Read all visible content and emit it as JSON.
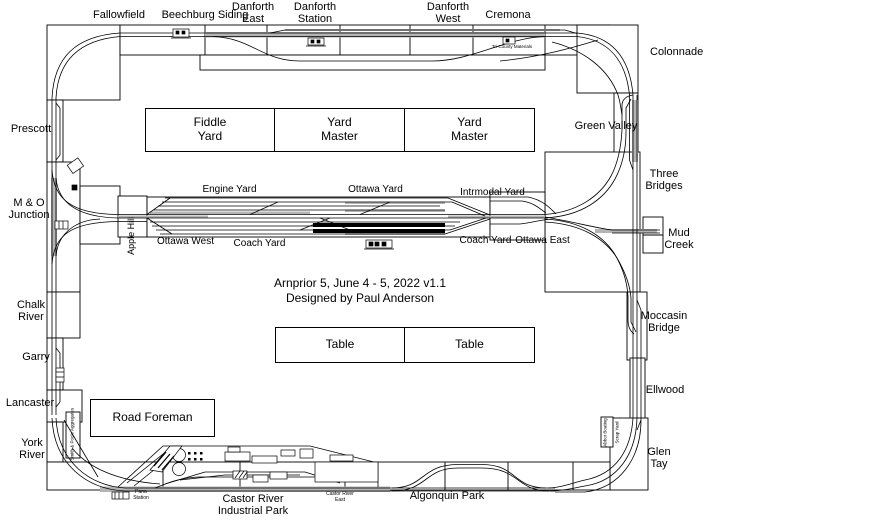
{
  "title": {
    "line1": "Arnprior 5, June 4 - 5, 2022 v1.1",
    "line2": "Designed by Paul Anderson"
  },
  "stations": {
    "top": [
      {
        "name": "Fallowfield"
      },
      {
        "name": "Beechburg Siding"
      },
      {
        "name": "Danforth East"
      },
      {
        "name": "Danforth Station"
      },
      {
        "name": "Danforth West"
      },
      {
        "name": "Cremona"
      }
    ],
    "left": [
      {
        "name": "Prescott"
      },
      {
        "name": "M & O Junction"
      },
      {
        "name": "Chalk River"
      },
      {
        "name": "Garry"
      },
      {
        "name": "Lancaster"
      },
      {
        "name": "York River"
      }
    ],
    "right": [
      {
        "name": "Colonnade"
      },
      {
        "name": "Green Valley"
      },
      {
        "name": "Three Bridges"
      },
      {
        "name": "Mud Creek"
      },
      {
        "name": "Moccasin Bridge"
      },
      {
        "name": "Ellwood"
      },
      {
        "name": "Glen Tay"
      }
    ],
    "bottom": [
      {
        "name": "Pana Station"
      },
      {
        "name": "Castor River Industrial Park"
      },
      {
        "name": "Castor River East"
      },
      {
        "name": "Algonquin Park"
      }
    ]
  },
  "yards": {
    "engine": "Engine Yard",
    "ottawa": "Ottawa Yard",
    "intermodal": "Intrmodal Yard",
    "ottawa_west": "Ottawa West",
    "coach_left": "Coach Yard",
    "coach_right": "Coach Yard",
    "ottawa_east": "Ottawa East",
    "apple_hill": "Apple Hill"
  },
  "operator_positions": {
    "fiddle_yard": "Fiddle Yard",
    "yard_master_1": "Yard Master",
    "yard_master_2": "Yard Master",
    "table_1": "Table",
    "table_2": "Table",
    "road_foreman": "Road Foreman"
  },
  "industries": {
    "aggregates": "Smith & Poole Aggregates",
    "boating": "Abbot Boating",
    "scrap": "Scrap Yard",
    "materials": "Tri-County Materials"
  }
}
